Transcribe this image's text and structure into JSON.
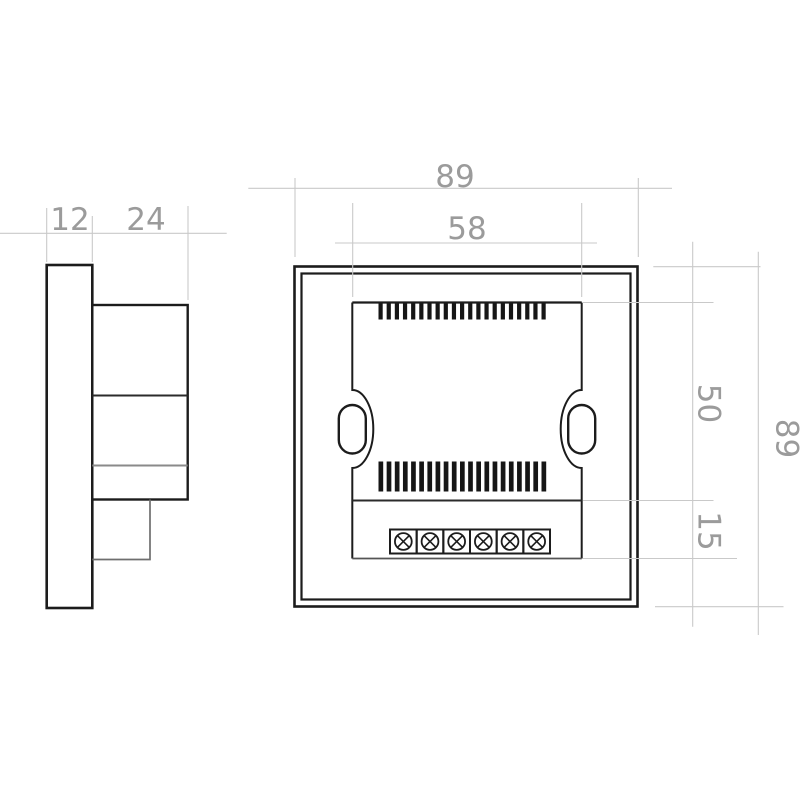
{
  "drawing": {
    "title": "wall-mount device dimension drawing",
    "dimensions": {
      "front_plate_thickness": "12",
      "body_depth": "24",
      "overall_width": "89",
      "plate_width": "58",
      "upper_section_height": "50",
      "terminal_section_height": "15",
      "overall_height": "89"
    },
    "vents": {
      "top_slot_count": 21,
      "bottom_slot_count": 21
    },
    "terminal": {
      "screw_count": 6
    },
    "colors": {
      "outline": "#1c1c1c",
      "secondary_line": "#6f6f6f",
      "dimension_line": "#c9c9c9",
      "dimension_text": "#9b9b9b",
      "background": "#ffffff"
    }
  }
}
